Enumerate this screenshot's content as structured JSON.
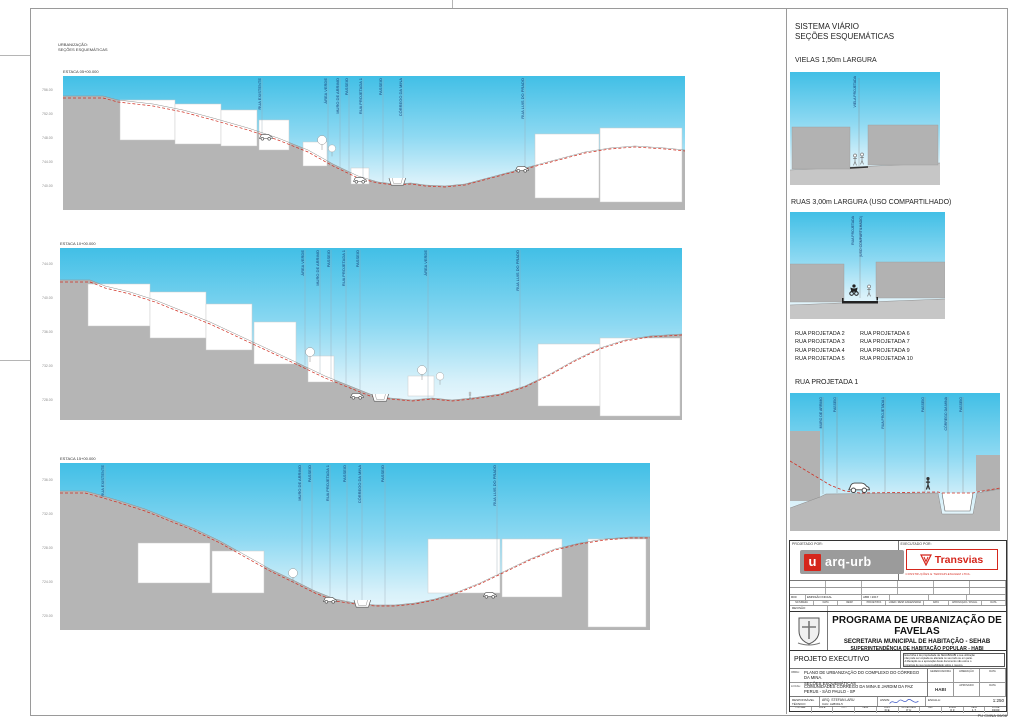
{
  "colors": {
    "sky_top": "#41bfe6",
    "sky_bottom": "#f3fbfe",
    "terrain": "#b5b5b5",
    "red_line": "#d02d20",
    "label_blue": "#1a3e75",
    "logo_red": "#d5261c"
  },
  "main": {
    "corner": {
      "line1": "URBANIZAÇÃO:",
      "line2": "SEÇÕES ESQUEMÁTICAS"
    },
    "sections": [
      {
        "estaca": "ESTACA 05+00.000",
        "labels": [
          "RUA EXISTENTE",
          "ÁREA VERDE",
          "MURO DE ARRIMO",
          "PASSEIO",
          "RUA PROJETADA 1",
          "PASSEIO",
          "CÓRREGO DA MINA",
          "RUA LUIS DO PRADO"
        ],
        "elevations": [
          "756.00",
          "752.00",
          "748.00",
          "744.00",
          "740.00"
        ]
      },
      {
        "estaca": "ESTACA 10+00.000",
        "labels": [
          "ÁREA VERDE",
          "MURO DE ARRIMO",
          "PASSEIO",
          "RUA PROJETADA 1",
          "PASSEIO",
          "ÁREA VERDE",
          "RUA LUIS DO PRADO"
        ],
        "elevations": [
          "744.00",
          "740.00",
          "736.00",
          "732.00",
          "728.00"
        ]
      },
      {
        "estaca": "ESTACA 15+00.000",
        "labels": [
          "RUA EXISTENTE",
          "MURO DE ARRIMO",
          "PASSEIO",
          "RUA PROJETADA 1",
          "PASSEIO",
          "CÓRREGO DA MINA",
          "PASSEIO",
          "RUA LUIS DO PRADO"
        ],
        "elevations": [
          "736.00",
          "732.00",
          "728.00",
          "724.00",
          "720.00"
        ]
      }
    ]
  },
  "sidebar": {
    "title1": "SISTEMA VIÁRIO",
    "title2": "SEÇÕES ESQUEMÁTICAS",
    "vielas": {
      "heading": "VIELAS 1,50m LARGURA",
      "label": "VIELA PROJETADA"
    },
    "ruas": {
      "heading": "RUAS 3,00m LARGURA (USO COMPARTILHADO)",
      "label1": "RUA PROJETADA",
      "label2": "(USO COMPARTILHADO)"
    },
    "list": {
      "col1": [
        "RUA PROJETADA 2",
        "RUA PROJETADA 3",
        "RUA PROJETADA 4",
        "RUA PROJETADA 5"
      ],
      "col2": [
        "RUA PROJETADA 6",
        "RUA PROJETADA 7",
        "RUA PROJETADA 9",
        "RUA PROJETADA 10"
      ]
    },
    "rua1": {
      "heading": "RUA PROJETADA 1",
      "labels": [
        "MURO DE ARRIMO",
        "PASSEIO",
        "RUA PROJETADA 1",
        "PASSEIO",
        "CÓRREGO DA MINA",
        "PASSEIO"
      ]
    }
  },
  "tb": {
    "projetado": "PROJETADO POR:",
    "executado": "EXECUTADO POR:",
    "arqurb_u": "u",
    "arqurb": "arq-urb",
    "transvias": "Transvias",
    "transvias_sub": "CONSTRUÇÕES E TERRAPLENAGEM LTDA.",
    "rev": {
      "code": "R00",
      "desc": "EMISSÃO INICIAL",
      "date": "ABR / 2017"
    },
    "rev_headers": [
      "NATUREZA",
      "DATA",
      "RESP.",
      "PROJETISTA",
      "LIDER / RESP. ENGENHARIA",
      "DATA",
      "APROVAÇÃO / FISCAL",
      "DATA"
    ],
    "revisao": "REVISÃO",
    "program": "PROGRAMA DE URBANIZAÇÃO DE FAVELAS",
    "secretaria": "SECRETARIA MUNICIPAL DE HABITAÇÃO - SEHAB",
    "superintendencia": "SUPERINTENDÊNCIA DE HABITAÇÃO POPULAR - HABI",
    "projeto": "PROJETO EXECUTIVO",
    "disclaimer": [
      "Esta folha é de propriedade da SEHAB/HABI e sua utilização",
      "não pode ser copiada ou alterada no seu todo ou em parte.",
      "A liberação ou a aprovação deste documento não exime o",
      "projetista de sua responsabilidade sobre o mesmo."
    ],
    "obra": {
      "label": "OBRA:",
      "line1": "PLANO DE URBANIZAÇÃO DO COMPLEXO DO CÓRREGO DA MINA.",
      "line2": "SEÇÕES ESQUEMÁTICAS"
    },
    "local": {
      "label": "LOCAL:",
      "line1": "COMUNIDADES CÓRREGO DA MINA E JARDIM DA PAZ",
      "line2": "PERUS - SÃO PAULO - SP"
    },
    "grid": {
      "r1c1": "GERENCIADORA",
      "r1c2": "LIBERAÇÃO",
      "r1c3": "DATA",
      "r2c1": "HABI",
      "r2c2": "APROVADO",
      "r2c3": "DATA"
    },
    "resp": {
      "label1": "RESPONSÁVEL",
      "label2": "TÉCNICO",
      "name": "ARQ. STEFAN LARU",
      "cau": "CAU: A28391-5",
      "assin": "ASSIN:",
      "escala_label": "ESCALA:",
      "escala": "1:250"
    },
    "codes": {
      "headers": [
        "COD-HAB",
        "SIGLA",
        "TIPO",
        "FASE",
        "VERS.",
        "MODALIDADE",
        "REF.",
        "ETAPA",
        "DATA",
        "FOLHA"
      ],
      "values": [
        "",
        "",
        "",
        "",
        "D E",
        "P U",
        "",
        "0 3",
        "1 7",
        "01/03"
      ]
    },
    "docnum": "PU CMNA 06/08"
  }
}
